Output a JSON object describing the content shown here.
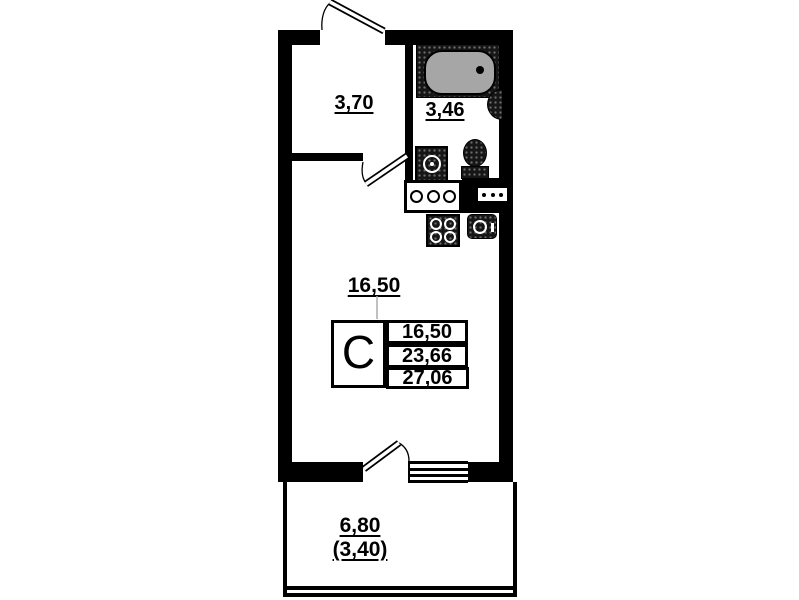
{
  "meta": {
    "title": "Studio apartment floor plan (scanned)"
  },
  "labels": {
    "hallway_area": "3,70",
    "bathroom_area": "3,46",
    "living_area": "16,50",
    "balcony_area": "6,80",
    "balcony_area_reduced": "(3,40)"
  },
  "info_table": {
    "room_type": "С",
    "rows": [
      {
        "value": "16,50"
      },
      {
        "value": "23,66"
      },
      {
        "value": "27,06"
      }
    ]
  },
  "icons": [
    "bathtub-icon",
    "water-heater-icon",
    "washing-machine-icon",
    "toilet-icon",
    "counter-sink-icon",
    "vent-grille-icon",
    "stove-icon",
    "kitchen-sink-icon",
    "window-symbol",
    "entrance-door-leaf",
    "interior-door-leaf",
    "balcony-door-leaf"
  ],
  "colors": {
    "wall": "#000000",
    "background": "#ffffff",
    "tub_fill": "#a6a6a6",
    "fixture_dark": "#161616",
    "leader_line": "#aaaaaa"
  }
}
